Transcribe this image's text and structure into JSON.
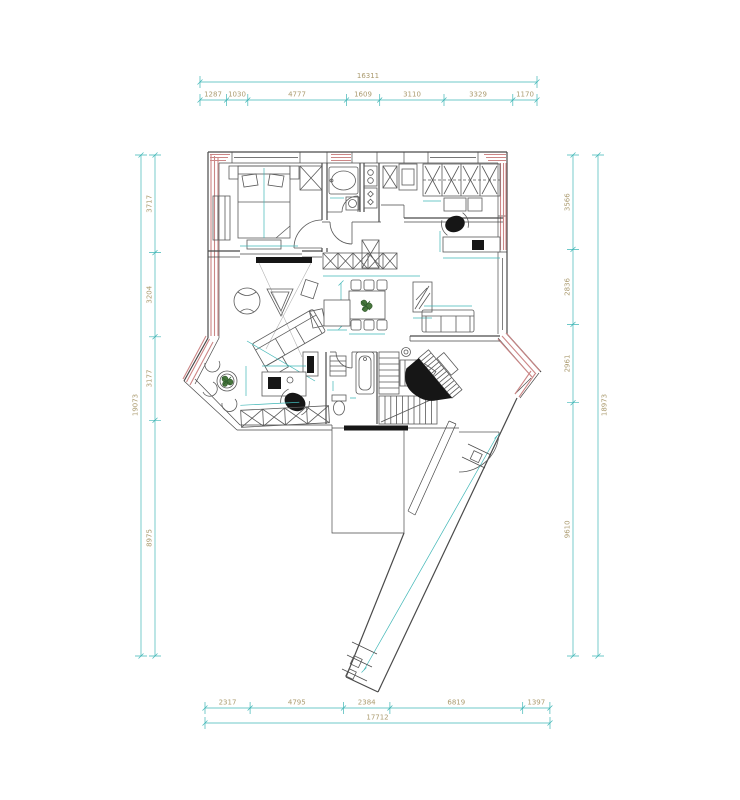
{
  "drawing": {
    "type": "architectural-floor-plan",
    "units": "mm",
    "colors": {
      "dimension_line": "#3fb6b6",
      "dimension_text": "#ab9b6f",
      "wall": "#4a4a4a",
      "exterior_wall_hatch": "#cc8686",
      "plant": "#47753c",
      "background": "#ffffff"
    },
    "symbols": [
      "double-bed",
      "wardrobe",
      "bathtub",
      "wash-basin",
      "kitchen-appliances",
      "fridge",
      "closet",
      "desk",
      "office-chair",
      "dining-table",
      "dining-chairs",
      "sofa-3seat",
      "armchair",
      "chaise-sofa",
      "tv-panel",
      "round-table",
      "side-chairs",
      "sideboard",
      "bathtub-small",
      "toilet",
      "staircase",
      "grand-piano",
      "stool",
      "corridor",
      "plant"
    ]
  },
  "dims": {
    "top": {
      "total": "16311",
      "parts": [
        "1287",
        "1030",
        "4777",
        "1609",
        "3110",
        "3329",
        "1170"
      ]
    },
    "bottom": {
      "total": "17712",
      "parts": [
        "2317",
        "4795",
        "2384",
        "6819",
        "1397"
      ]
    },
    "left": {
      "total": "19073",
      "parts": [
        "3717",
        "3204",
        "3177",
        "8975"
      ]
    },
    "right": {
      "total": "18973",
      "parts": [
        "3566",
        "2836",
        "2961",
        "9610"
      ]
    }
  }
}
